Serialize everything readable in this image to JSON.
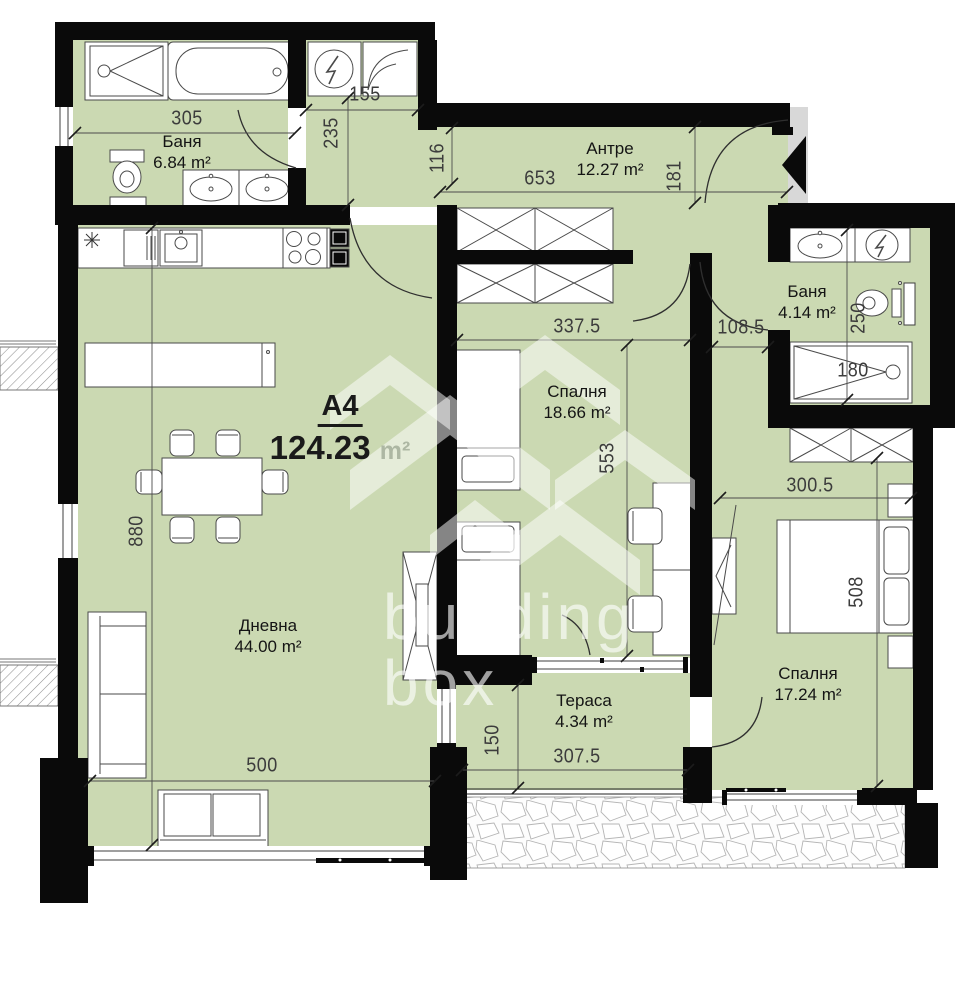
{
  "plan": {
    "unit_label": "А4",
    "total_area": "124.23",
    "area_unit": "m²"
  },
  "watermark": {
    "brand_line1": "building",
    "brand_line2": "box"
  },
  "rooms": {
    "bath1": {
      "name": "Баня",
      "area": "6.84 m²"
    },
    "entry_hall": {
      "name": "Антре",
      "area": "12.27 m²"
    },
    "bath2": {
      "name": "Баня",
      "area": "4.14 m²"
    },
    "bedroom1": {
      "name": "Спалня",
      "area": "18.66 m²"
    },
    "bedroom2": {
      "name": "Спалня",
      "area": "17.24 m²"
    },
    "living": {
      "name": "Дневна",
      "area": "44.00 m²"
    },
    "terrace": {
      "name": "Тераса",
      "area": "4.34 m²"
    }
  },
  "dimensions": {
    "bath1_width": "305",
    "appliance_nook_width": "155",
    "corridor_depth": "235",
    "corridor_width": "116",
    "hall_width": "653",
    "hall_depth": "181",
    "bedroom1_width": "337.5",
    "bedroom1_depth": "553",
    "passage_width": "108.5",
    "bath2_depth": "250",
    "shower_length": "180",
    "bedroom2_width": "300.5",
    "bedroom2_depth": "508",
    "living_depth": "880",
    "living_width": "500",
    "terrace_depth": "150",
    "terrace_width": "307.5"
  },
  "colors": {
    "room_fill": "#cbd9b2",
    "wall": "#0a0a0a",
    "entry_zone": "#d8d8d8"
  }
}
